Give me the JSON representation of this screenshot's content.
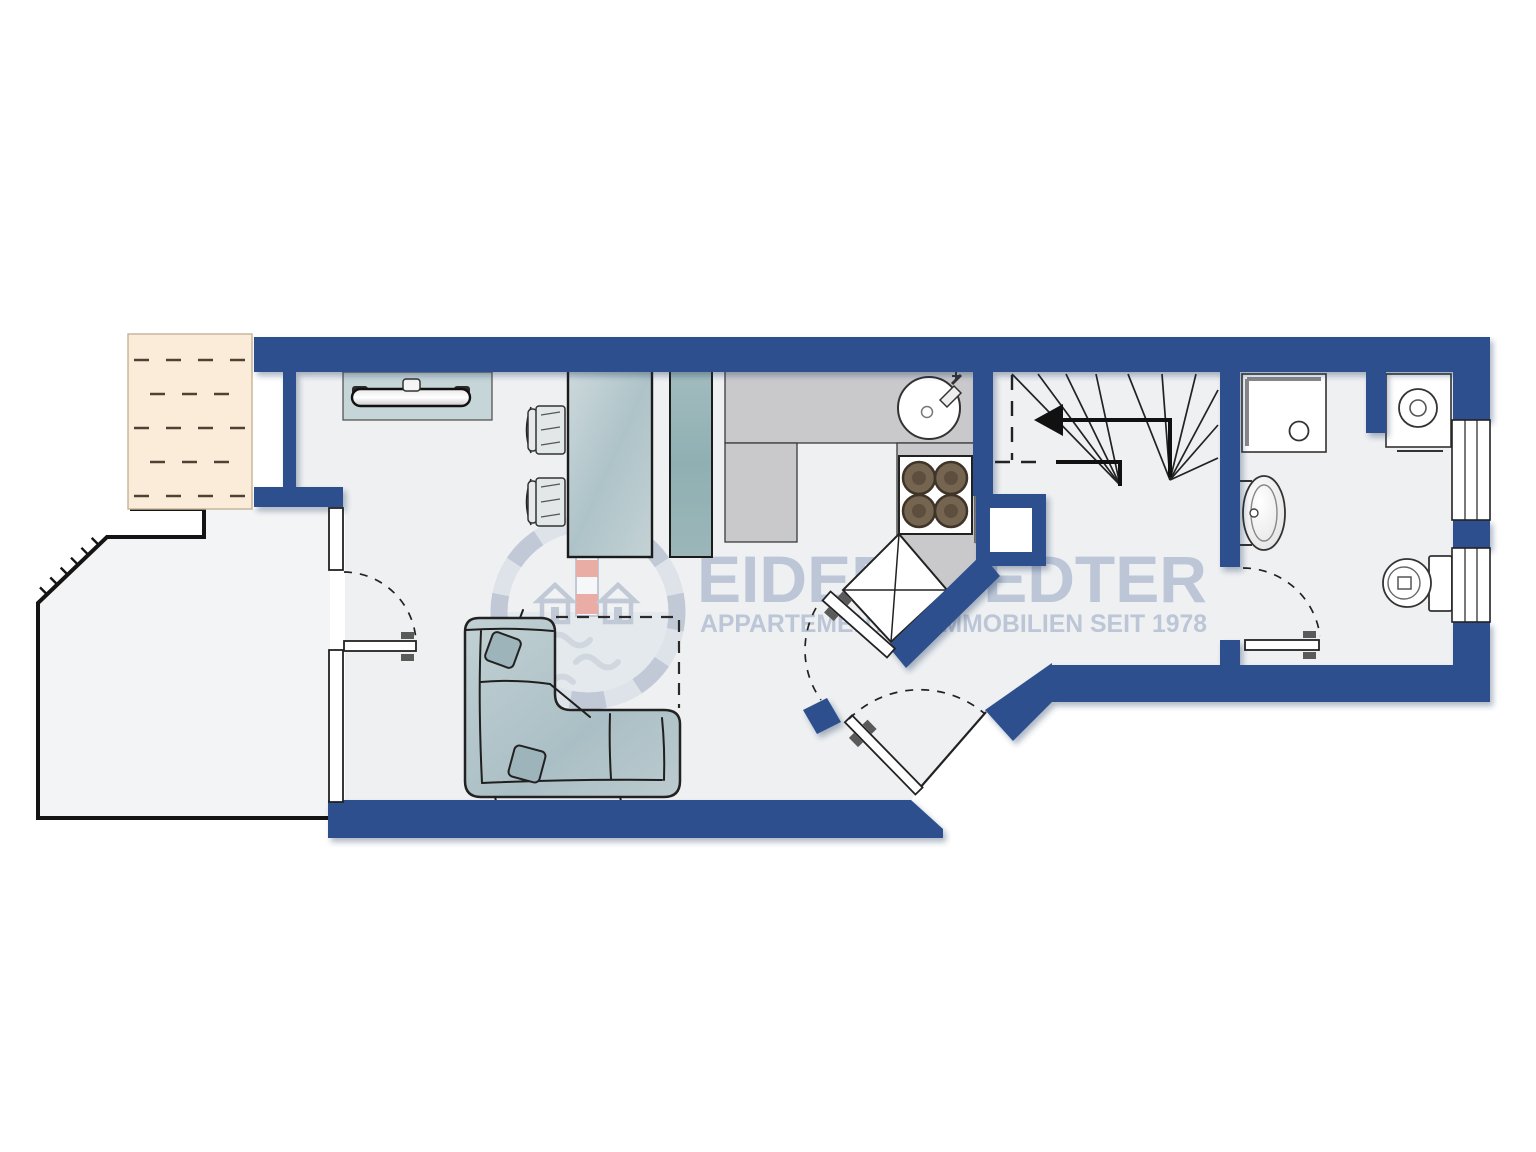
{
  "watermark": {
    "brand": "EIDERSTEDTER",
    "tagline": "APPARTEMENTS & IMMOBILIEN SEIT 1978"
  },
  "palette": {
    "page": "#ffffff",
    "floor": "#eef0f2",
    "wall": "#2d4f8e",
    "outline": "#1c1c1e",
    "decking": "#fbecd9",
    "decking_dash": "#4d4234",
    "counter": "#c9c9cc",
    "burner": "#756450",
    "divider_teal": "#97b5b8",
    "furniture_blue": "#b9cbd0",
    "watermark_blue": "#b3bed2",
    "watermark_red": "#e2604e"
  },
  "elements": [
    "terrace-decking",
    "terrace",
    "living-room",
    "kitchen",
    "hallway",
    "bathroom",
    "winder-staircase",
    "stair-direction-arrow",
    "tv-sideboard",
    "dining-table",
    "dining-chairs",
    "room-divider",
    "kitchen-counter",
    "kitchen-sink",
    "stove",
    "corner-cabinet",
    "shaft-niche",
    "corner-sofa",
    "sofa-cushions",
    "rug-outline",
    "shower",
    "washing-machine",
    "bathroom-sink",
    "toilet",
    "windows",
    "terrace-door",
    "kitchen-door",
    "entrance-door",
    "bathroom-door",
    "brand-watermark"
  ]
}
